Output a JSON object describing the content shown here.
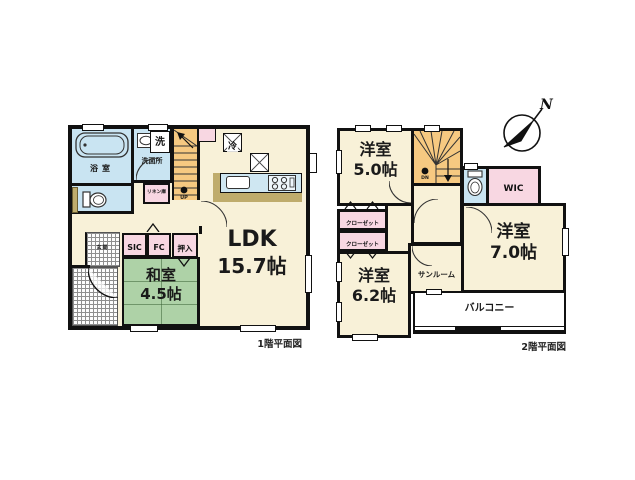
{
  "f1": {
    "caption": "1階平面図",
    "ldk": {
      "name": "LDK",
      "size": "15.7帖"
    },
    "washitsu": {
      "name": "和室",
      "size": "4.5帖"
    },
    "bath": "浴室",
    "washroom": "洗面所",
    "laundry": "洗",
    "linen": "リネン庫",
    "fridge": "冷",
    "up": "UP",
    "sic": "SIC",
    "fc": "FC",
    "oshiire": "押入",
    "genkan": "玄関"
  },
  "f2": {
    "caption": "2階平面図",
    "bed5": {
      "name": "洋室",
      "size": "5.0帖"
    },
    "bed62": {
      "name": "洋室",
      "size": "6.2帖"
    },
    "bed7": {
      "name": "洋室",
      "size": "7.0帖"
    },
    "wic": "WIC",
    "closet1": "クローゼット",
    "closet2": "クローゼット",
    "sunroom": "サンルーム",
    "balcony": "バルコニー",
    "dn": "DN"
  },
  "compass": {
    "label": "N"
  },
  "colors": {
    "wall": "#111111",
    "floor_cream": "#f8f1d8",
    "tatami_green": "#aed2a7",
    "water_blue": "#c9e4f2",
    "stairs_orange": "#f6c981",
    "closet_pink": "#f8d7e2",
    "counter_tan": "#bfac6c"
  }
}
